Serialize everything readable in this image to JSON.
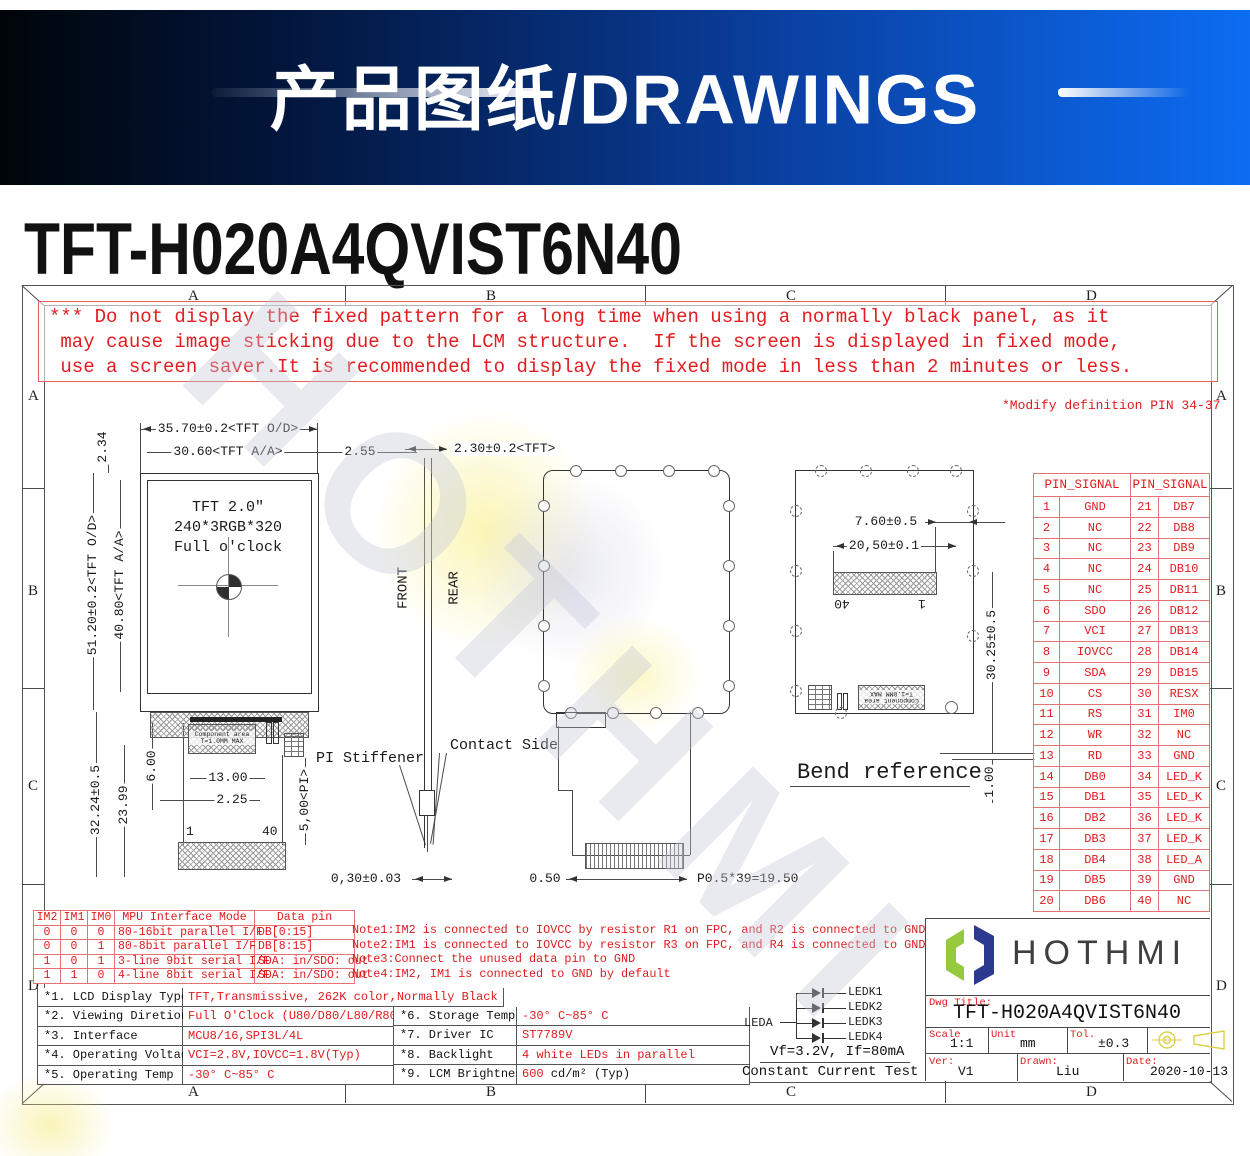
{
  "banner": {
    "title": "产品图纸/DRAWINGS"
  },
  "page_title": "TFT-H020A4QVIST6N40",
  "zones": {
    "cols": [
      "A",
      "B",
      "C",
      "D"
    ],
    "rows": [
      "A",
      "B",
      "C",
      "D"
    ]
  },
  "warning_lines": [
    "*** Do not display the fixed pattern for a long time when using a normally black panel, as it",
    " may cause image sticking due to the LCM structure.  If the screen is displayed in fixed mode,",
    " use a screen saver.It is recommended to display the fixed mode in less than 2 minutes or less."
  ],
  "modify_note": "*Modify definition PIN 34-37",
  "front_view": {
    "screen_text": [
      "TFT 2.0\"",
      "240*3RGB*320",
      "Full o'clock"
    ],
    "dims": {
      "od_w": "35.70±0.2<TFT O/D>",
      "aa_w": "30.60<TFT A/A>",
      "gap_right": "2.55",
      "top_bezel": "2.34",
      "od_h": "51.20±0.2<TFT O/D>",
      "aa_h": "40.80<TFT A/A>",
      "fpc_h": "32.24±0.5",
      "fpc_h2": "23.99",
      "comp_offset": "6.00",
      "comp_w": "13.00",
      "comp_x": "2.25",
      "pi_h": "5,00<PI>",
      "fpc_t": "0,30±0.03"
    },
    "comp_line1": "Component area",
    "comp_line2": "T=1.0MM MAX",
    "pin_first": "1",
    "pin_last": "40",
    "pi_stiffener": "PI Stiffener"
  },
  "side_view": {
    "front": "FRONT",
    "rear": "REAR",
    "thickness": "2.30±0.2<TFT>",
    "contact_side": "Contact Side"
  },
  "rear_view": {
    "conn_edge": "0.50",
    "pitch": "P0.5*39=19.50"
  },
  "bend_view": {
    "title": "Bend reference",
    "dims": {
      "d1": "7.60±0.5",
      "d2": "20,50±0.1",
      "d3": "30.25±0.5",
      "d4": "1.00"
    },
    "pin_left": "40",
    "pin_right": "1",
    "comp_line1": "Component area",
    "comp_line2": "T=1.0MM MAX"
  },
  "pin_table": {
    "header": "PIN_SIGNAL",
    "rows": [
      [
        "1",
        "GND",
        "21",
        "DB7"
      ],
      [
        "2",
        "NC",
        "22",
        "DB8"
      ],
      [
        "3",
        "NC",
        "23",
        "DB9"
      ],
      [
        "4",
        "NC",
        "24",
        "DB10"
      ],
      [
        "5",
        "NC",
        "25",
        "DB11"
      ],
      [
        "6",
        "SDO",
        "26",
        "DB12"
      ],
      [
        "7",
        "VCI",
        "27",
        "DB13"
      ],
      [
        "8",
        "IOVCC",
        "28",
        "DB14"
      ],
      [
        "9",
        "SDA",
        "29",
        "DB15"
      ],
      [
        "10",
        "CS",
        "30",
        "RESX"
      ],
      [
        "11",
        "RS",
        "31",
        "IM0"
      ],
      [
        "12",
        "WR",
        "32",
        "NC"
      ],
      [
        "13",
        "RD",
        "33",
        "GND"
      ],
      [
        "14",
        "DB0",
        "34",
        "LED_K"
      ],
      [
        "15",
        "DB1",
        "35",
        "LED_K"
      ],
      [
        "16",
        "DB2",
        "36",
        "LED_K"
      ],
      [
        "17",
        "DB3",
        "37",
        "LED_K"
      ],
      [
        "18",
        "DB4",
        "38",
        "LED_A"
      ],
      [
        "19",
        "DB5",
        "39",
        "GND"
      ],
      [
        "20",
        "DB6",
        "40",
        "NC"
      ]
    ]
  },
  "mpu_table": {
    "headers": [
      "IM2",
      "IM1",
      "IM0",
      "MPU Interface Mode",
      "Data pin"
    ],
    "rows": [
      [
        "0",
        "0",
        "0",
        "80-16bit parallel I/F",
        "DB[0:15]"
      ],
      [
        "0",
        "0",
        "1",
        "80-8bit parallel I/F",
        "DB[8:15]"
      ],
      [
        "1",
        "0",
        "1",
        "3-line 9bit serial I/F",
        "SDA: in/SDO: out"
      ],
      [
        "1",
        "1",
        "0",
        "4-line 8bit serial I/F",
        "SDA: in/SDO: out"
      ]
    ]
  },
  "notes": [
    "Note1:IM2 is connected to IOVCC by resistor R1 on FPC, and R2 is connected to GND",
    "Note2:IM1 is connected to IOVCC by resistor R3 on FPC, and R4 is connected to GND",
    "Note3:Connect the unused data pin to GND",
    "Note4:IM2, IM1 is connected to GND by default"
  ],
  "spec_left": [
    {
      "label": "*1. LCD Display Type",
      "value": "TFT,Transmissive, 262K color,Normally Black"
    },
    {
      "label": "*2. Viewing Diretion",
      "value": "Full O'Clock (U80/D80/L80/R80)"
    },
    {
      "label": "*3. Interface",
      "value": "MCU8/16,SPI3L/4L"
    },
    {
      "label": "*4. Operating Voltage",
      "value": "VCI=2.8V,IOVCC=1.8V(Typ)"
    },
    {
      "label": "*5. Operating Temp",
      "value": "-30° C~85° C"
    }
  ],
  "spec_right": [
    {
      "label": "*6. Storage Temp",
      "value": "-30° C~85° C"
    },
    {
      "label": "*7. Driver IC",
      "value": "ST7789V"
    },
    {
      "label": "*8. Backlight",
      "value": "4 white LEDs in parallel"
    },
    {
      "label": "*9. LCM Brightness",
      "value": "600",
      "value2": " cd/m² (Typ)"
    }
  ],
  "backlight": {
    "leda": "LEDA",
    "ledk": [
      "LEDK1",
      "LEDK2",
      "LEDK3",
      "LEDK4"
    ],
    "test_line1": "Vf=3.2V, If=80mA",
    "test_line2": "Constant Current Test"
  },
  "title_block": {
    "brand": "HOTHMI",
    "dwg_title_label": "Dwg Title:",
    "dwg_title": "TFT-H020A4QVIST6N40",
    "scale_label": "Scale",
    "scale": "1:1",
    "unit_label": "Unit",
    "unit": "mm",
    "tol_label": "Tol.",
    "tol": "±0.3",
    "ver_label": "Ver:",
    "ver": "V1",
    "drawn_label": "Drawn:",
    "drawn": "Liu",
    "date_label": "Date:",
    "date": "2020-10-13"
  },
  "colors": {
    "banner_blue": "#0c6cf2",
    "drawing_red": "#e01b1e",
    "logo_green": "#96c93e",
    "logo_navy": "#2b3a8f",
    "projection_yellow": "#ddd04a"
  }
}
